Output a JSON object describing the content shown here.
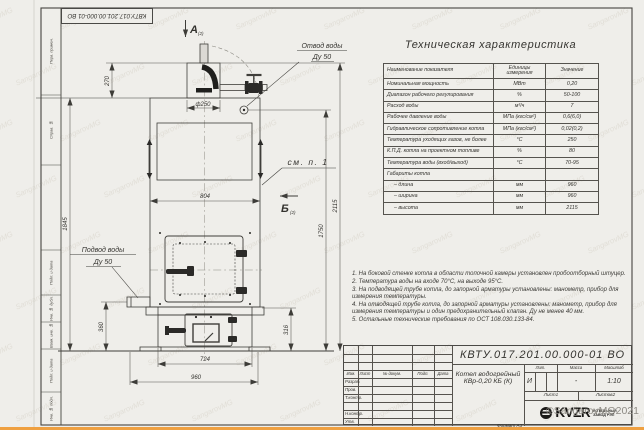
{
  "page": {
    "watermark": "SangarovMG",
    "copyright": "©SangarovMG2021",
    "format_note": "Формат А3"
  },
  "frame": {
    "top_stamp": "КВТУ.017.201.00.000-01 ВО",
    "left_labels": [
      "Перв. примен.",
      "Справ. №",
      "Подп. и дата",
      "Инв. № дубл.",
      "Взам. инв. №",
      "Подп. и дата",
      "Инв. № подл."
    ]
  },
  "drawing": {
    "view_a": "А",
    "view_a_sheet": "(2)",
    "view_b": "Б",
    "view_b_sheet": "(2)",
    "see_note": "см. п. 1",
    "outlet_line1": "Отвод воды",
    "outlet_line2": "Ду 50",
    "inlet_line1": "Подвод воды",
    "inlet_line2": "Ду 50",
    "dim_270": "270",
    "dim_1845": "1845",
    "dim_dia250": "ф250",
    "dim_804": "804",
    "dim_360": "360",
    "dim_724": "724",
    "dim_960": "960",
    "dim_316": "316",
    "dim_1750": "1750",
    "dim_2115": "2115"
  },
  "spec": {
    "title": "Техническая характеристика",
    "col_name": "Наименование показателя",
    "col_units": "Единицы измерения",
    "col_value": "Значение",
    "rows": [
      {
        "name": "Номинальная мощность",
        "units": "МВт",
        "value": "0,20"
      },
      {
        "name": "Диапазон рабочего регулирования",
        "units": "%",
        "value": "50-100"
      },
      {
        "name": "Расход воды",
        "units": "м³/ч",
        "value": "7"
      },
      {
        "name": "Рабочее давление воды",
        "units": "МПа (кгс/см²)",
        "value": "0,6(6,0)"
      },
      {
        "name": "Гидравлическое сопротивление котла",
        "units": "МПа (кгс/см²)",
        "value": "0,02(0,2)"
      },
      {
        "name": "Температура уходящих газов, не более",
        "units": "°С",
        "value": "250"
      },
      {
        "name": "К.П.Д. котла на проектном топливе",
        "units": "%",
        "value": "80"
      },
      {
        "name": "Температура воды (вход/выход)",
        "units": "°С",
        "value": "70-95"
      },
      {
        "name": "Габариты котла",
        "units": "",
        "value": ""
      },
      {
        "name": "– длина",
        "units": "мм",
        "value": "960"
      },
      {
        "name": "– ширина",
        "units": "мм",
        "value": "960"
      },
      {
        "name": "– высота",
        "units": "мм",
        "value": "2115"
      }
    ]
  },
  "notes": [
    "1. На боковой стенке котла в области топочной камеры установлен пробоотборный штуцер.",
    "2. Температура воды на входе 70°С, на выходе 95°С.",
    "3. На подводящей трубе котла, до запорной арматуры установлены: манометр, прибор для измерения температуры.",
    "4. На отводящей трубе котла, до запорной арматуры установлены: манометр, прибор для измерения температуры и один предохранительный клапан. Ду не менее 40 мм.",
    "5. Остальные технические требования по ОСТ 108.030.133-84."
  ],
  "title_block": {
    "code": "КВТУ.017.201.00.000-01 ВО",
    "title_line1": "Котел водогрейный",
    "title_line2": "КВр-0,20 КБ (К)",
    "cols": [
      "Изм.",
      "Лист",
      "№ докум.",
      "Подп.",
      "Дата"
    ],
    "sign_rows": [
      "Разраб.",
      "Пров.",
      "Т.контр.",
      "",
      "Н.контр.",
      "Утв."
    ],
    "lit_label": "Лит.",
    "mass_label": "Масса",
    "scale_label": "Масштаб",
    "lit": "И",
    "mass": "-",
    "scale": "1:10",
    "sheet_label": "Лист",
    "sheet": "1",
    "sheets_label": "Листов",
    "sheets": "2",
    "logo_text": "KVZR",
    "logo_line1": "КОТЕЛЬНЫЙ",
    "logo_line2": "ЗАВОД  РЭП"
  }
}
